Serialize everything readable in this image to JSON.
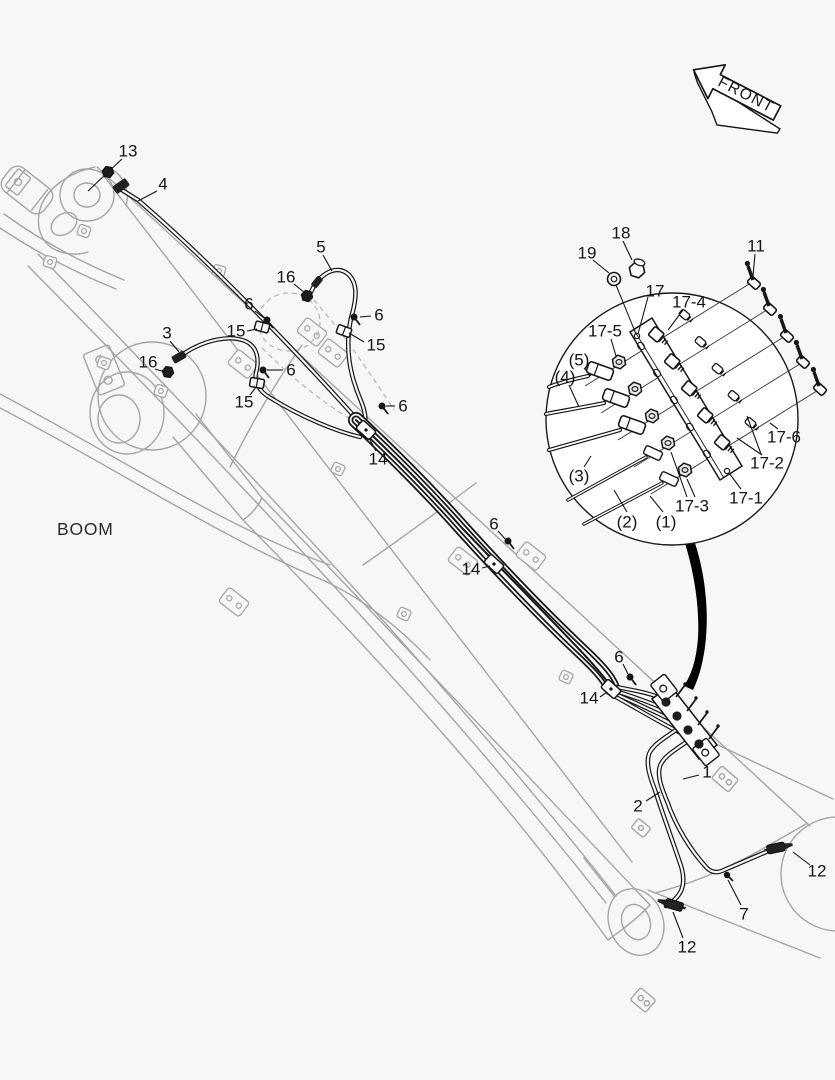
{
  "front_arrow": {
    "label": "FRONT"
  },
  "boom_label": {
    "text": "BOOM"
  },
  "colors": {
    "background": "#f7f7f7",
    "structure": "#a5a5a5",
    "pipe": "#161616",
    "label": "#141414"
  },
  "callouts": [
    {
      "t": "13",
      "x": 128,
      "y": 151,
      "l": [
        [
          122,
          159,
          88,
          191
        ]
      ]
    },
    {
      "t": "4",
      "x": 163,
      "y": 184,
      "l": [
        [
          157,
          191,
          138,
          201
        ]
      ]
    },
    {
      "t": "5",
      "x": 321,
      "y": 247,
      "l": [
        [
          323,
          255,
          332,
          271
        ]
      ]
    },
    {
      "t": "16",
      "x": 286,
      "y": 277,
      "l": [
        [
          294,
          284,
          305,
          293
        ]
      ]
    },
    {
      "t": "6",
      "x": 379,
      "y": 315,
      "l": [
        [
          371,
          316,
          360,
          317
        ]
      ]
    },
    {
      "t": "15",
      "x": 376,
      "y": 345,
      "l": [
        [
          364,
          342,
          349,
          333
        ]
      ]
    },
    {
      "t": "6",
      "x": 249,
      "y": 304,
      "l": [
        [
          255,
          311,
          264,
          318
        ]
      ]
    },
    {
      "t": "15",
      "x": 236,
      "y": 331,
      "l": [
        [
          247,
          331,
          257,
          329
        ]
      ]
    },
    {
      "t": "3",
      "x": 167,
      "y": 333,
      "l": [
        [
          170,
          341,
          179,
          352
        ]
      ]
    },
    {
      "t": "16",
      "x": 148,
      "y": 362,
      "l": [
        [
          155,
          369,
          165,
          372
        ]
      ]
    },
    {
      "t": "6",
      "x": 291,
      "y": 370,
      "l": [
        [
          283,
          370,
          267,
          370
        ]
      ]
    },
    {
      "t": "15",
      "x": 244,
      "y": 402,
      "l": [
        [
          250,
          395,
          256,
          387
        ]
      ]
    },
    {
      "t": "6",
      "x": 403,
      "y": 406,
      "l": [
        [
          395,
          406,
          386,
          406
        ]
      ]
    },
    {
      "t": "14",
      "x": 378,
      "y": 459,
      "l": [
        [
          376,
          451,
          369,
          438
        ]
      ]
    },
    {
      "t": "6",
      "x": 494,
      "y": 524,
      "l": [
        [
          498,
          531,
          506,
          540
        ]
      ]
    },
    {
      "t": "14",
      "x": 471,
      "y": 569,
      "l": [
        [
          482,
          568,
          490,
          566
        ]
      ]
    },
    {
      "t": "6",
      "x": 619,
      "y": 657,
      "l": [
        [
          623,
          664,
          628,
          674
        ]
      ]
    },
    {
      "t": "14",
      "x": 589,
      "y": 698,
      "l": [
        [
          600,
          697,
          607,
          692
        ]
      ]
    },
    {
      "t": "1",
      "x": 707,
      "y": 772,
      "l": [
        [
          699,
          775,
          683,
          779
        ]
      ]
    },
    {
      "t": "2",
      "x": 638,
      "y": 806,
      "l": [
        [
          646,
          801,
          660,
          792
        ]
      ]
    },
    {
      "t": "12",
      "x": 817,
      "y": 871,
      "l": [
        [
          810,
          865,
          793,
          852
        ]
      ]
    },
    {
      "t": "7",
      "x": 744,
      "y": 914,
      "l": [
        [
          741,
          905,
          728,
          880
        ]
      ]
    },
    {
      "t": "12",
      "x": 687,
      "y": 947,
      "l": [
        [
          683,
          938,
          673,
          912
        ]
      ]
    },
    {
      "t": "18",
      "x": 621,
      "y": 233,
      "l": [
        [
          623,
          241,
          632,
          260
        ]
      ]
    },
    {
      "t": "19",
      "x": 587,
      "y": 253,
      "l": [
        [
          593,
          260,
          609,
          273
        ]
      ]
    },
    {
      "t": "11",
      "x": 756,
      "y": 246,
      "l": [
        [
          755,
          254,
          753,
          276
        ]
      ]
    },
    {
      "t": "17",
      "x": 655,
      "y": 291,
      "l": [
        [
          648,
          297,
          638,
          334
        ]
      ]
    },
    {
      "t": "17-4",
      "x": 689,
      "y": 302,
      "l": [
        [
          683,
          310,
          668,
          330
        ]
      ]
    },
    {
      "t": "17-5",
      "x": 605,
      "y": 331,
      "l": [
        [
          611,
          339,
          616,
          356
        ]
      ]
    },
    {
      "t": "(5)",
      "x": 579,
      "y": 360,
      "l": [
        [
          584,
          368,
          591,
          376
        ]
      ]
    },
    {
      "t": "(4)",
      "x": 565,
      "y": 377,
      "l": [
        [
          569,
          385,
          579,
          407
        ]
      ]
    },
    {
      "t": "(3)",
      "x": 579,
      "y": 476,
      "l": [
        [
          584,
          467,
          591,
          456
        ]
      ]
    },
    {
      "t": "(2)",
      "x": 627,
      "y": 522,
      "l": [
        [
          627,
          512,
          614,
          490
        ]
      ]
    },
    {
      "t": "(1)",
      "x": 666,
      "y": 522,
      "l": [
        [
          663,
          512,
          650,
          496
        ]
      ]
    },
    {
      "t": "17-3",
      "x": 692,
      "y": 506,
      "l": [
        [
          687,
          497,
          671,
          452
        ],
        [
          695,
          497,
          687,
          479
        ]
      ]
    },
    {
      "t": "17-1",
      "x": 746,
      "y": 498,
      "l": [
        [
          741,
          489,
          729,
          473
        ]
      ]
    },
    {
      "t": "17-2",
      "x": 767,
      "y": 463,
      "l": [
        [
          761,
          454,
          747,
          416
        ],
        [
          762,
          455,
          737,
          438
        ]
      ]
    },
    {
      "t": "17-6",
      "x": 784,
      "y": 437,
      "l": [
        [
          778,
          429,
          770,
          423
        ]
      ]
    }
  ]
}
